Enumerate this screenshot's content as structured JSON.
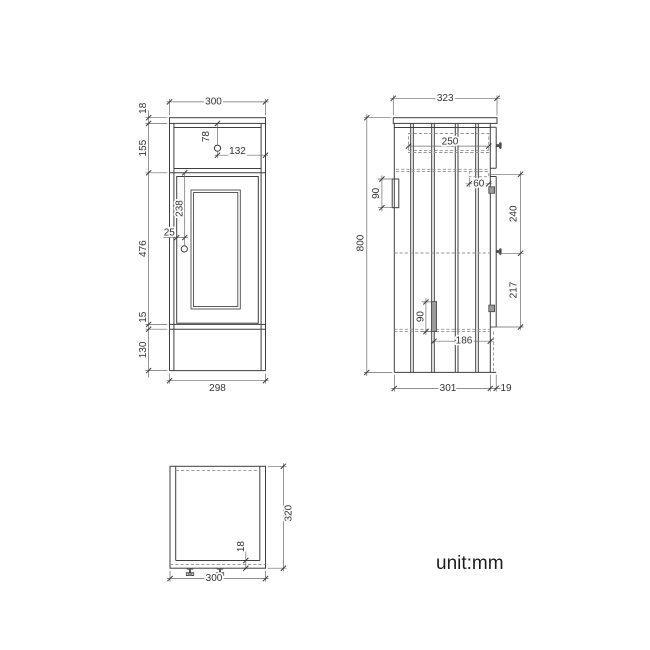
{
  "colors": {
    "line": "#3f3f3f",
    "hidden_line": "#949494",
    "text": "#333333",
    "background": "#ffffff"
  },
  "unit_note": {
    "label": "unit:mm"
  },
  "front_view": {
    "dims": {
      "width_top": "300",
      "countertop_thickness": "18",
      "drawer_section_height": "155",
      "door_height": "476",
      "under_door_gap": "15",
      "plinth_height": "130",
      "width_bottom": "298",
      "drawer_knob_offset_top": "78",
      "drawer_knob_offset_side": "132",
      "door_knob_offset_top": "238",
      "door_knob_offset_edge": "25"
    }
  },
  "side_view": {
    "dims": {
      "depth_top": "323",
      "overall_height": "800",
      "drawer_box_depth": "250",
      "upper_bracket_height": "90",
      "runner_bracket_width": "60",
      "knob_spacing_upper": "240",
      "knob_spacing_lower": "217",
      "lower_bracket_height": "90",
      "bottom_shelf_depth": "186",
      "carcass_depth": "301",
      "door_thickness": "19"
    }
  },
  "plan_view": {
    "dims": {
      "depth": "320",
      "width": "300",
      "bottom_panel_thickness": "18"
    }
  }
}
